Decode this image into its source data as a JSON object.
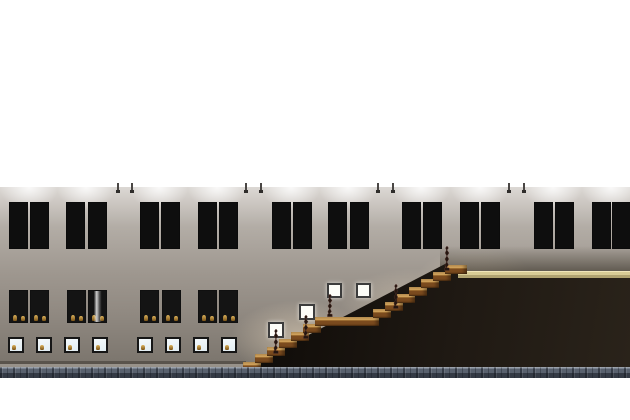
{
  "canvas": {
    "width": 630,
    "height": 420,
    "background": "#ffffff"
  },
  "wall": {
    "x": 0,
    "y": 187,
    "width": 630,
    "height": 180,
    "gradient": [
      "#dcd8d4",
      "#b3ada6",
      "#9e978f",
      "#8f8880",
      "#7a746c"
    ]
  },
  "slab": {
    "x": 0,
    "y": 367,
    "width": 630,
    "height": 11,
    "base": "#59616e",
    "dark": "#343a45",
    "light": "#79828f"
  },
  "floor_band": {
    "x": 458,
    "y": 271,
    "width": 172,
    "height": 7,
    "colors": [
      "#f0e6ba",
      "#d8cc96",
      "#b0a371"
    ]
  },
  "dark_zone": {
    "x": 240,
    "y": 263,
    "width": 390,
    "height": 106,
    "polygon": [
      [
        3,
        106
      ],
      [
        205,
        1
      ],
      [
        228,
        10
      ],
      [
        390,
        10
      ],
      [
        390,
        106
      ]
    ],
    "colors": [
      "#0d0a07",
      "#1f1913",
      "#2a231a"
    ]
  },
  "baseboard": {
    "x": 0,
    "y": 361,
    "width": 246,
    "shadow": "rgba(55,50,44,0.5)",
    "light": "rgba(205,200,192,0.35)"
  },
  "pendant_lights": {
    "xs": [
      117,
      131,
      245,
      260,
      377,
      392,
      508,
      523
    ],
    "line_color": "#4a4745",
    "tip_color": "#2f2d2b"
  },
  "light_pools": {
    "centers": [
      29,
      86,
      159,
      217,
      291,
      348,
      421,
      480,
      553,
      611
    ],
    "y": 184
  },
  "warm_glows": [
    {
      "x": 230,
      "y": 300,
      "w": 140,
      "h": 70,
      "a": 0.5
    },
    {
      "x": 340,
      "y": 268,
      "w": 150,
      "h": 70,
      "a": 0.4
    },
    {
      "x": 415,
      "y": 248,
      "w": 120,
      "h": 60,
      "a": 0.35
    }
  ],
  "right_shade": {
    "x": 440,
    "y": 246,
    "width": 190,
    "height": 27
  },
  "upper_windows": {
    "y": 202,
    "width": 19,
    "height": 47,
    "frame": "#0e0e0e",
    "clear": "#e7eff4",
    "lower_glass": "#f0f6f9",
    "items": [
      {
        "x": 9,
        "left": "clear",
        "right": "clear"
      },
      {
        "x": 30,
        "left": "#e98f95",
        "right": "#e9db9b"
      },
      {
        "x": 66,
        "left": "#a88ee4",
        "right": "#9265da"
      },
      {
        "x": 88,
        "left": "clear",
        "right": "clear"
      },
      {
        "x": 140,
        "left": "#d9e87b",
        "right": "#8fe78f"
      },
      {
        "x": 161,
        "left": "#e98f95",
        "right": "#e9db9b"
      },
      {
        "x": 198,
        "left": "#7fe3da",
        "right": "#8fa9ea"
      },
      {
        "x": 219,
        "left": "#9d7ce6",
        "right": "#a070e0"
      },
      {
        "x": 272,
        "left": "#8ae8a8",
        "right": "#72c9e8"
      },
      {
        "x": 293,
        "left": "#e8e87a",
        "right": "#a0e888"
      },
      {
        "x": 328,
        "left": "clear",
        "right": "clear"
      },
      {
        "x": 350,
        "left": "#e98f95",
        "right": "#e9db9b"
      },
      {
        "x": 402,
        "left": "#a88ee4",
        "right": "#9265da"
      },
      {
        "x": 423,
        "left": "#a580e0",
        "right": "#e09ad8"
      },
      {
        "x": 460,
        "left": "#88e8a8",
        "right": "#70d8e8"
      },
      {
        "x": 481,
        "left": "clear",
        "right": "clear"
      },
      {
        "x": 534,
        "left": "#ab85e2",
        "right": "#e49ac8"
      },
      {
        "x": 555,
        "left": "#e29598",
        "right": "#ded49a"
      },
      {
        "x": 592,
        "left": "clear",
        "right": "clear"
      },
      {
        "x": 612,
        "left": "#5fe0c5",
        "right": "#7d95e8"
      }
    ]
  },
  "mid_windows": {
    "y": 290,
    "width": 19,
    "height": 33,
    "xs": [
      9,
      30,
      67,
      88,
      140,
      162,
      198,
      219
    ],
    "bright_index": 3
  },
  "small_windows": {
    "y": 337,
    "size": 16,
    "xs": [
      8,
      36,
      64,
      92,
      137,
      165,
      193,
      221
    ]
  },
  "wall_frames": [
    {
      "x": 268,
      "y": 322,
      "size": 16
    },
    {
      "x": 299,
      "y": 304,
      "size": 16
    },
    {
      "x": 327,
      "y": 283,
      "size": 15
    },
    {
      "x": 356,
      "y": 283,
      "size": 15
    }
  ],
  "stairs": {
    "step_height": 9,
    "tread_top": "#d2a35c",
    "tread_mid": "#9a6a30",
    "tread_face": "#7b4b1e",
    "steps": [
      [
        243,
        361.5,
        18
      ],
      [
        255,
        354,
        18
      ],
      [
        267,
        346.5,
        18
      ],
      [
        279,
        339,
        18
      ],
      [
        291,
        331.5,
        18
      ],
      [
        303,
        324,
        18
      ],
      [
        315,
        316.5,
        64
      ],
      [
        373,
        309,
        18
      ],
      [
        385,
        301.5,
        18
      ],
      [
        397,
        294,
        18
      ],
      [
        409,
        286.5,
        18
      ],
      [
        421,
        279,
        18
      ],
      [
        433,
        271.5,
        18
      ],
      [
        445,
        264.5,
        22
      ]
    ]
  },
  "statues": {
    "fill": "#241610",
    "edge": "#5a352f",
    "items": [
      [
        276,
        355,
        26
      ],
      [
        306,
        340,
        25
      ],
      [
        330,
        318,
        24
      ],
      [
        396,
        310,
        26
      ],
      [
        447,
        272,
        26
      ]
    ]
  },
  "figure_gold": [
    "#dbb25c",
    "#7c5417"
  ]
}
